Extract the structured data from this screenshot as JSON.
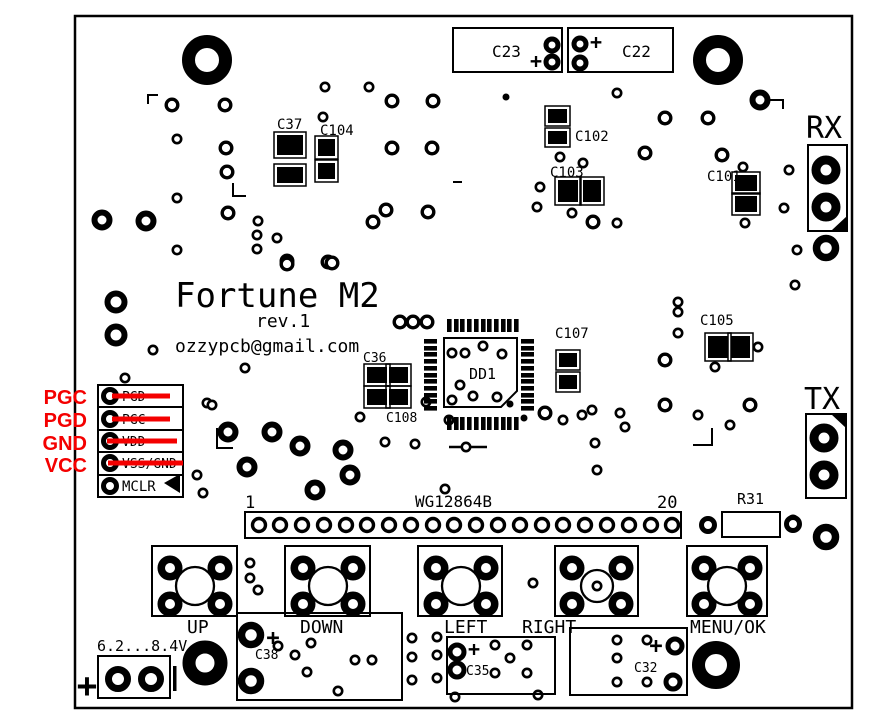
{
  "board": {
    "title": "Fortune M2",
    "revision": "rev.1",
    "email": "ozzypcb@gmail.com",
    "colors": {
      "silkscreen": "#000000",
      "background": "#ffffff",
      "annotation_red": "#f40000"
    }
  },
  "programming_header": {
    "annotations": {
      "a1": "PGC",
      "a2": "PGD",
      "a3": "GND",
      "a4": "VCC"
    },
    "pins": {
      "p1": "PGD",
      "p2": "PGC",
      "p3": "VDD",
      "p4": "VSS/GND",
      "p5": "MCLR"
    }
  },
  "serial": {
    "rx": "RX",
    "tx": "TX"
  },
  "lcd_connector": {
    "label": "WG12864B",
    "pin_first": "1",
    "pin_last": "20"
  },
  "components": {
    "c23": "C23",
    "c22": "C22",
    "c37": "C37",
    "c104": "C104",
    "c102": "C102",
    "c103": "C103",
    "c101": "C101",
    "c36": "C36",
    "c108": "C108",
    "c107": "C107",
    "c105": "C105",
    "c38": "C38",
    "c35": "C35",
    "c32": "C32",
    "r31": "R31",
    "dd1": "DD1"
  },
  "buttons": {
    "up": "UP",
    "down": "DOWN",
    "left": "LEFT",
    "right": "RIGHT",
    "menu": "MENU/OK"
  },
  "power_input": {
    "voltage_range": "6.2...8.4V"
  },
  "marks": {
    "plus": "+"
  }
}
